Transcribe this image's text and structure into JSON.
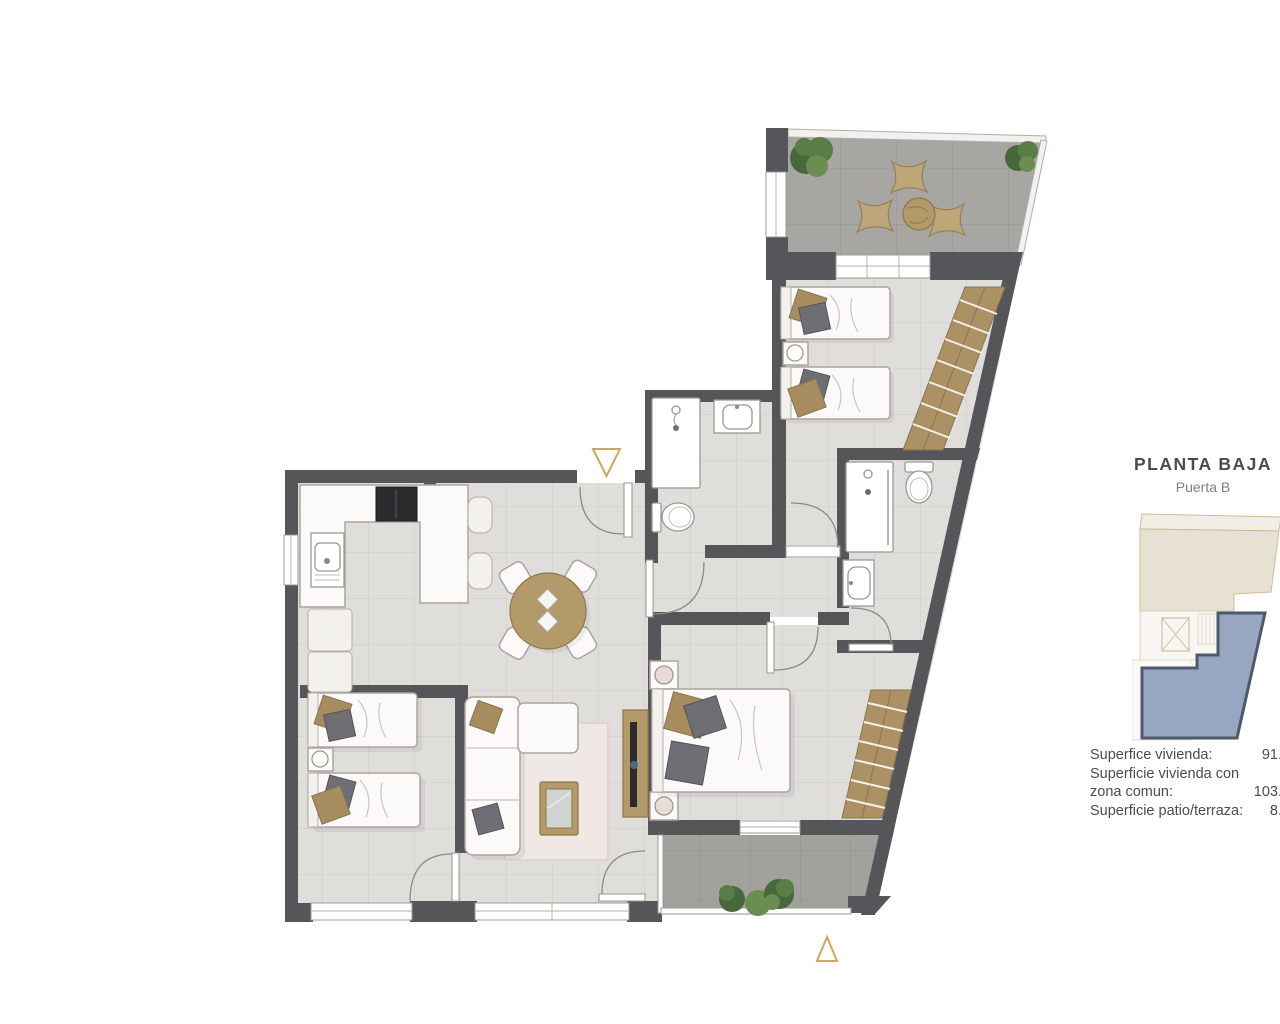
{
  "header": {
    "title": "PLANTA BAJA",
    "subtitle": "Puerta B"
  },
  "areas": {
    "line1_label": "Superfice vivienda:",
    "line1_value": "91.",
    "line2_label": "Superficie vivienda con",
    "line3_label": "zona comun:",
    "line3_value": "103.",
    "line4_label": "Superficie patio/terraza:",
    "line4_value": "8."
  },
  "markers": {
    "top_entrance_marker": "triangle-down-outline",
    "bottom_entrance_marker": "triangle-up-outline"
  },
  "colors": {
    "wall": "#56555a",
    "floor": "#dfdedb",
    "floor_grid": "#cbcac6",
    "terrace_floor": "#a8a6a2",
    "patio_floor": "#a3a19c",
    "wood": "#b49a6a",
    "wardrobe": "#ab9164",
    "pillow_tan": "#a68c5f",
    "pillow_gray": "#6f6e74",
    "accent_gold": "#c9a95e",
    "inset_beige": "#e7e1d4",
    "inset_highlight": "#98a7c1",
    "inset_outline": "#4e5a6c",
    "title_color": "#4b4b4d",
    "subtitle_color": "#808080"
  }
}
